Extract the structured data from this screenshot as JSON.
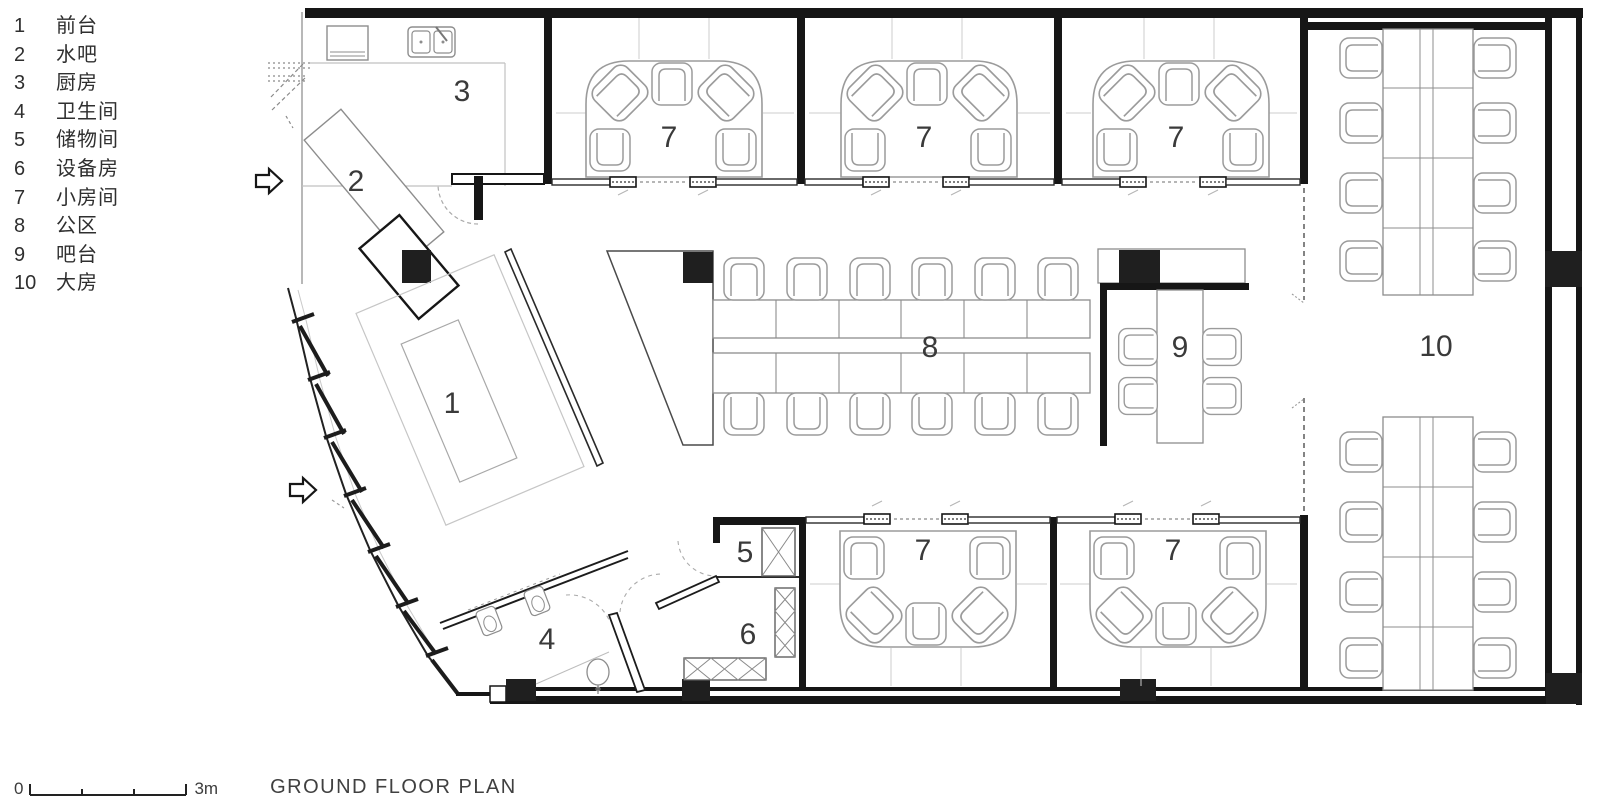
{
  "legend": {
    "items": [
      {
        "num": "1",
        "label": "前台"
      },
      {
        "num": "2",
        "label": "水吧"
      },
      {
        "num": "3",
        "label": "厨房"
      },
      {
        "num": "4",
        "label": "卫生间"
      },
      {
        "num": "5",
        "label": "储物间"
      },
      {
        "num": "6",
        "label": "设备房"
      },
      {
        "num": "7",
        "label": "小房间"
      },
      {
        "num": "8",
        "label": "公区"
      },
      {
        "num": "9",
        "label": "吧台"
      },
      {
        "num": "10",
        "label": "大房"
      }
    ]
  },
  "rooms": {
    "reception": "1",
    "water_bar": "2",
    "kitchen": "3",
    "bathroom": "4",
    "storage": "5",
    "equipment": "6",
    "small_room": "7",
    "public_area": "8",
    "bar_counter": "9",
    "big_room": "10"
  },
  "footer": {
    "scale_start": "0",
    "scale_end": "3m",
    "title": "GROUND FLOOR PLAN"
  },
  "colors": {
    "wall": "#1a1a1a",
    "partition": "#454545",
    "furniture": "#9b9b9b",
    "guide": "#c9c9c9",
    "label": "#3a3a3a"
  }
}
